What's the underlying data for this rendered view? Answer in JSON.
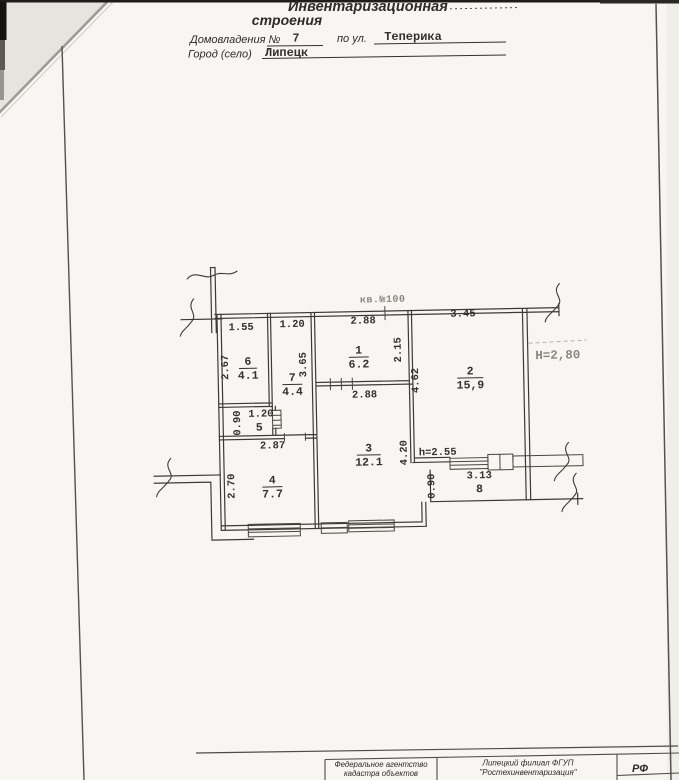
{
  "header": {
    "title_line1": "Инвентаризационная",
    "title_line2": "строения",
    "field1_label": "Домовладения №",
    "field1_value": "7",
    "field2_label": "по ул.",
    "field2_value": "Теперика",
    "field3_label": "Город (село)",
    "field3_value": "Липецк"
  },
  "plan": {
    "apartment_label": "кв.№100",
    "height_main": "H=2,80",
    "height_balcony": "h=2.55",
    "rooms": [
      {
        "number": "1",
        "area": "6.2"
      },
      {
        "number": "2",
        "area": "15,9"
      },
      {
        "number": "3",
        "area": "12.1"
      },
      {
        "number": "4",
        "area": "7.7"
      },
      {
        "number": "5"
      },
      {
        "number": "6",
        "area": "4.1"
      },
      {
        "number": "7",
        "area": "4.4"
      },
      {
        "number": "8"
      }
    ],
    "dims": {
      "w6": "1.55",
      "h6": "2.67",
      "w7": "1.20",
      "h7": "3.65",
      "w1": "2.88",
      "h1": "2.15",
      "w1b": "2.88",
      "w2": "3.45",
      "h2": "4.62",
      "w5": "1.20",
      "h5": "0.90",
      "w4": "2.87",
      "h4": "2.70",
      "h3": "4.20",
      "w8": "3.13",
      "h8": "0.90"
    }
  },
  "footer": {
    "org1_line1": "Федеральное агентство",
    "org1_line2": "кадастра объектов",
    "org2_line1": "Липецкий филиал ФГУП",
    "org2_line2": "\"Ростехинвентаризация\"",
    "country": "РФ"
  },
  "colors": {
    "paper": "#f7f6f2",
    "ink": "#34312d",
    "faded_ink": "#8a8781"
  }
}
